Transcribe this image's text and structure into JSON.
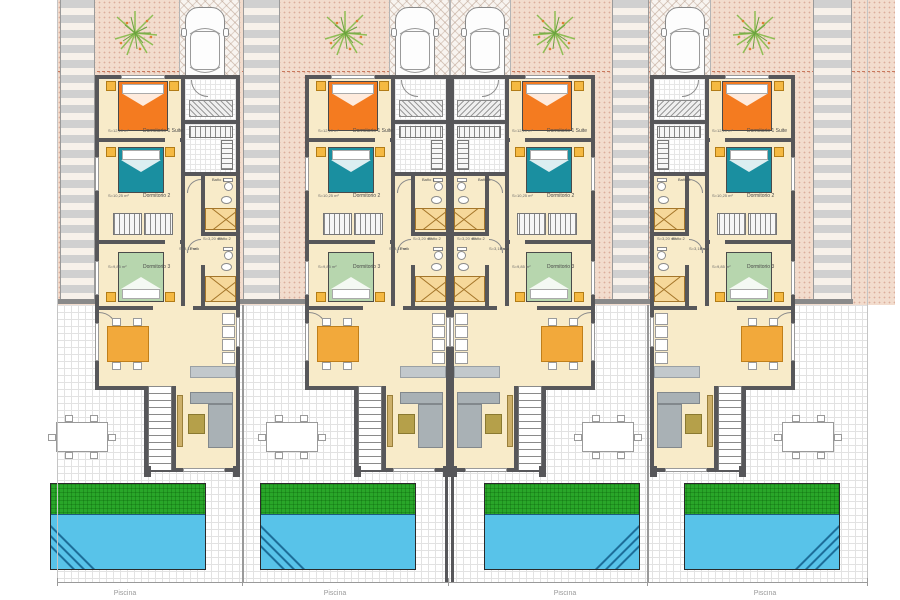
{
  "site": {
    "type": "Residential floor plan — 4 attached townhouses with private pools",
    "pool_caption": "Piscina",
    "colors": {
      "ground_pink": "#f2dccd",
      "floor_cream": "#f8ebc9",
      "wall_gray": "#57575a",
      "bed_orange": "#f47b20",
      "bed_teal": "#1a8fa0",
      "bed_green": "#b7d6ae",
      "nightstand_yellow": "#f5b942",
      "pool_water_blue": "#58c3e9",
      "lawn_green": "#29a629",
      "dining_orange": "#f2a93b",
      "setback_line": "#c97a5f"
    }
  },
  "rooms": {
    "bedroom1": {
      "name": "Dormitorio 1 Suite",
      "area": "S=12,10 m²"
    },
    "bedroom2": {
      "name": "Dormitorio 2",
      "area": "S=10,25 m²"
    },
    "bedroom3": {
      "name": "Dormitorio 3",
      "area": "S=9,85 m²"
    },
    "bath1": {
      "name": "Baño 1",
      "area": "S=4,05 m²"
    },
    "bath2": {
      "name": "Baño 2",
      "area": "S=3,20 m²"
    },
    "paso": {
      "name": "Paso",
      "area": "S=3,15 m²"
    }
  },
  "units": [
    {
      "id": 1,
      "mirrored": false
    },
    {
      "id": 2,
      "mirrored": false
    },
    {
      "id": 3,
      "mirrored": true
    },
    {
      "id": 4,
      "mirrored": true
    }
  ]
}
